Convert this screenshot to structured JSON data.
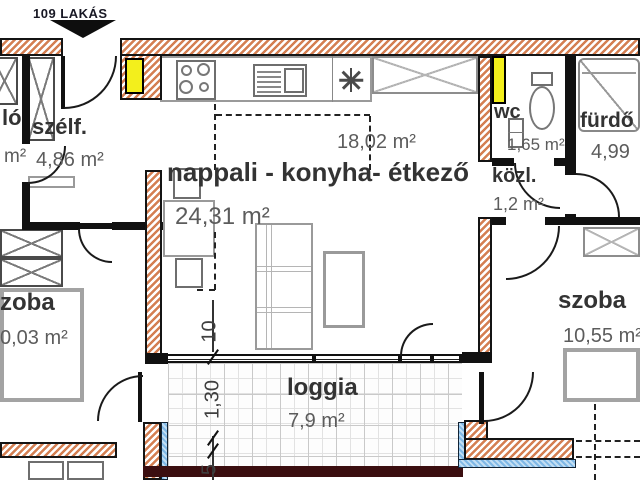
{
  "header": {
    "apartment_label": "109 LAKÁS"
  },
  "rooms": {
    "living": {
      "name": "nappali - konyha- étkező",
      "area": "24,31 m²",
      "kitchen_area": "18,02 m²"
    },
    "vestibule": {
      "name": "szélf.",
      "area": "4,86 m²"
    },
    "hall_clipped": {
      "name_fragment": "ló",
      "area_fragment": "m²"
    },
    "wc": {
      "name": "wc",
      "area": "1,65 m²"
    },
    "bathroom": {
      "name": "fürdő",
      "area": "4,99"
    },
    "corridor": {
      "name": "közl.",
      "area": "1,2 m²"
    },
    "bedroom_left": {
      "name_fragment": "zoba",
      "area_fragment": "0,03 m²"
    },
    "bedroom_right": {
      "name": "szoba",
      "area": "10,55 m²"
    },
    "loggia": {
      "name": "loggia",
      "area": "7,9 m²"
    }
  },
  "dimensions": {
    "wall_thickness": "10",
    "loggia_depth": "1,30",
    "parapet": "5"
  },
  "colors": {
    "wall_hatch": "#d47f52",
    "shaft": "#f3ef1c",
    "insulation": "#8fc2e8",
    "slab_edge": "#3b0e10"
  }
}
